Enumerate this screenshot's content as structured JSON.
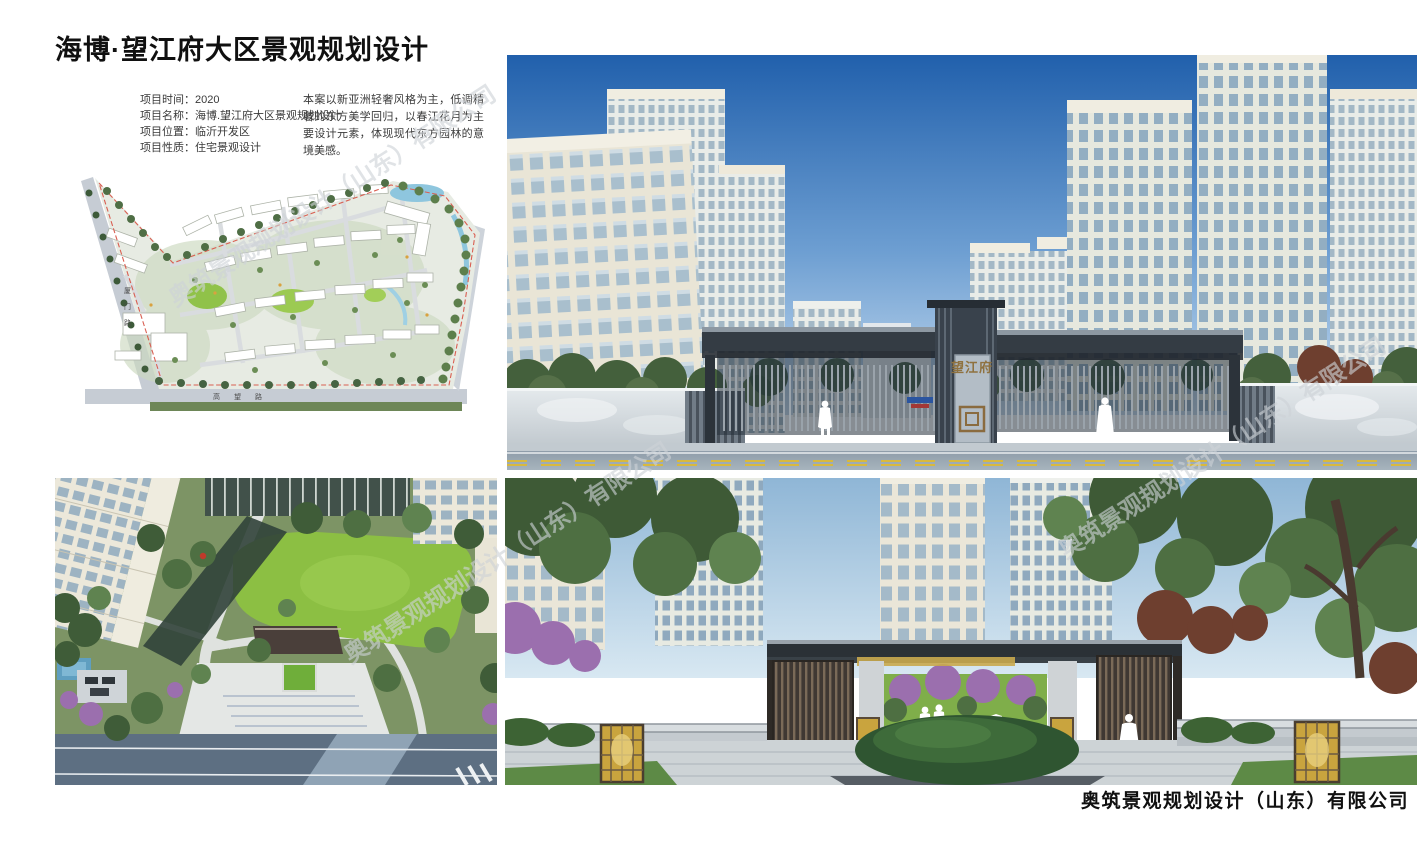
{
  "page": {
    "title": "海博·望江府大区景观规划设计",
    "footer_company": "奥筑景观规划设计（山东）有限公司",
    "watermark_text": "奥筑景观规划设计（山东）有限公司"
  },
  "project_info": {
    "rows": [
      {
        "label": "项目时间：",
        "value": "2020"
      },
      {
        "label": "项目名称：",
        "value": "海博.望江府大区景观规划设计"
      },
      {
        "label": "项目位置：",
        "value": "临沂开发区"
      },
      {
        "label": "项目性质：",
        "value": "住宅景观设计"
      }
    ],
    "description": "本案以新亚洲轻奢风格为主，低调精奢的东方美学回归，以春江花月为主要设计元素，体现现代东方园林的意境美感。"
  },
  "site_plan": {
    "road_left_label": "厦门路",
    "road_bottom_label": "高望路"
  },
  "gate_render": {
    "sign_text": "望江府"
  },
  "colors": {
    "sky_blue": "#2160ac",
    "canopy_dark": "#343c44",
    "lawn_green": "#8cbf43",
    "marble_gray": "#d7dce0",
    "road_gray": "#93a1ad",
    "lantern_gold": "#c9a43e",
    "boundary_red": "#d95f52",
    "tree_green": "#4f6e45",
    "maroon_foliage": "#6e3f2f",
    "purple_bloom": "#9b6fae"
  }
}
